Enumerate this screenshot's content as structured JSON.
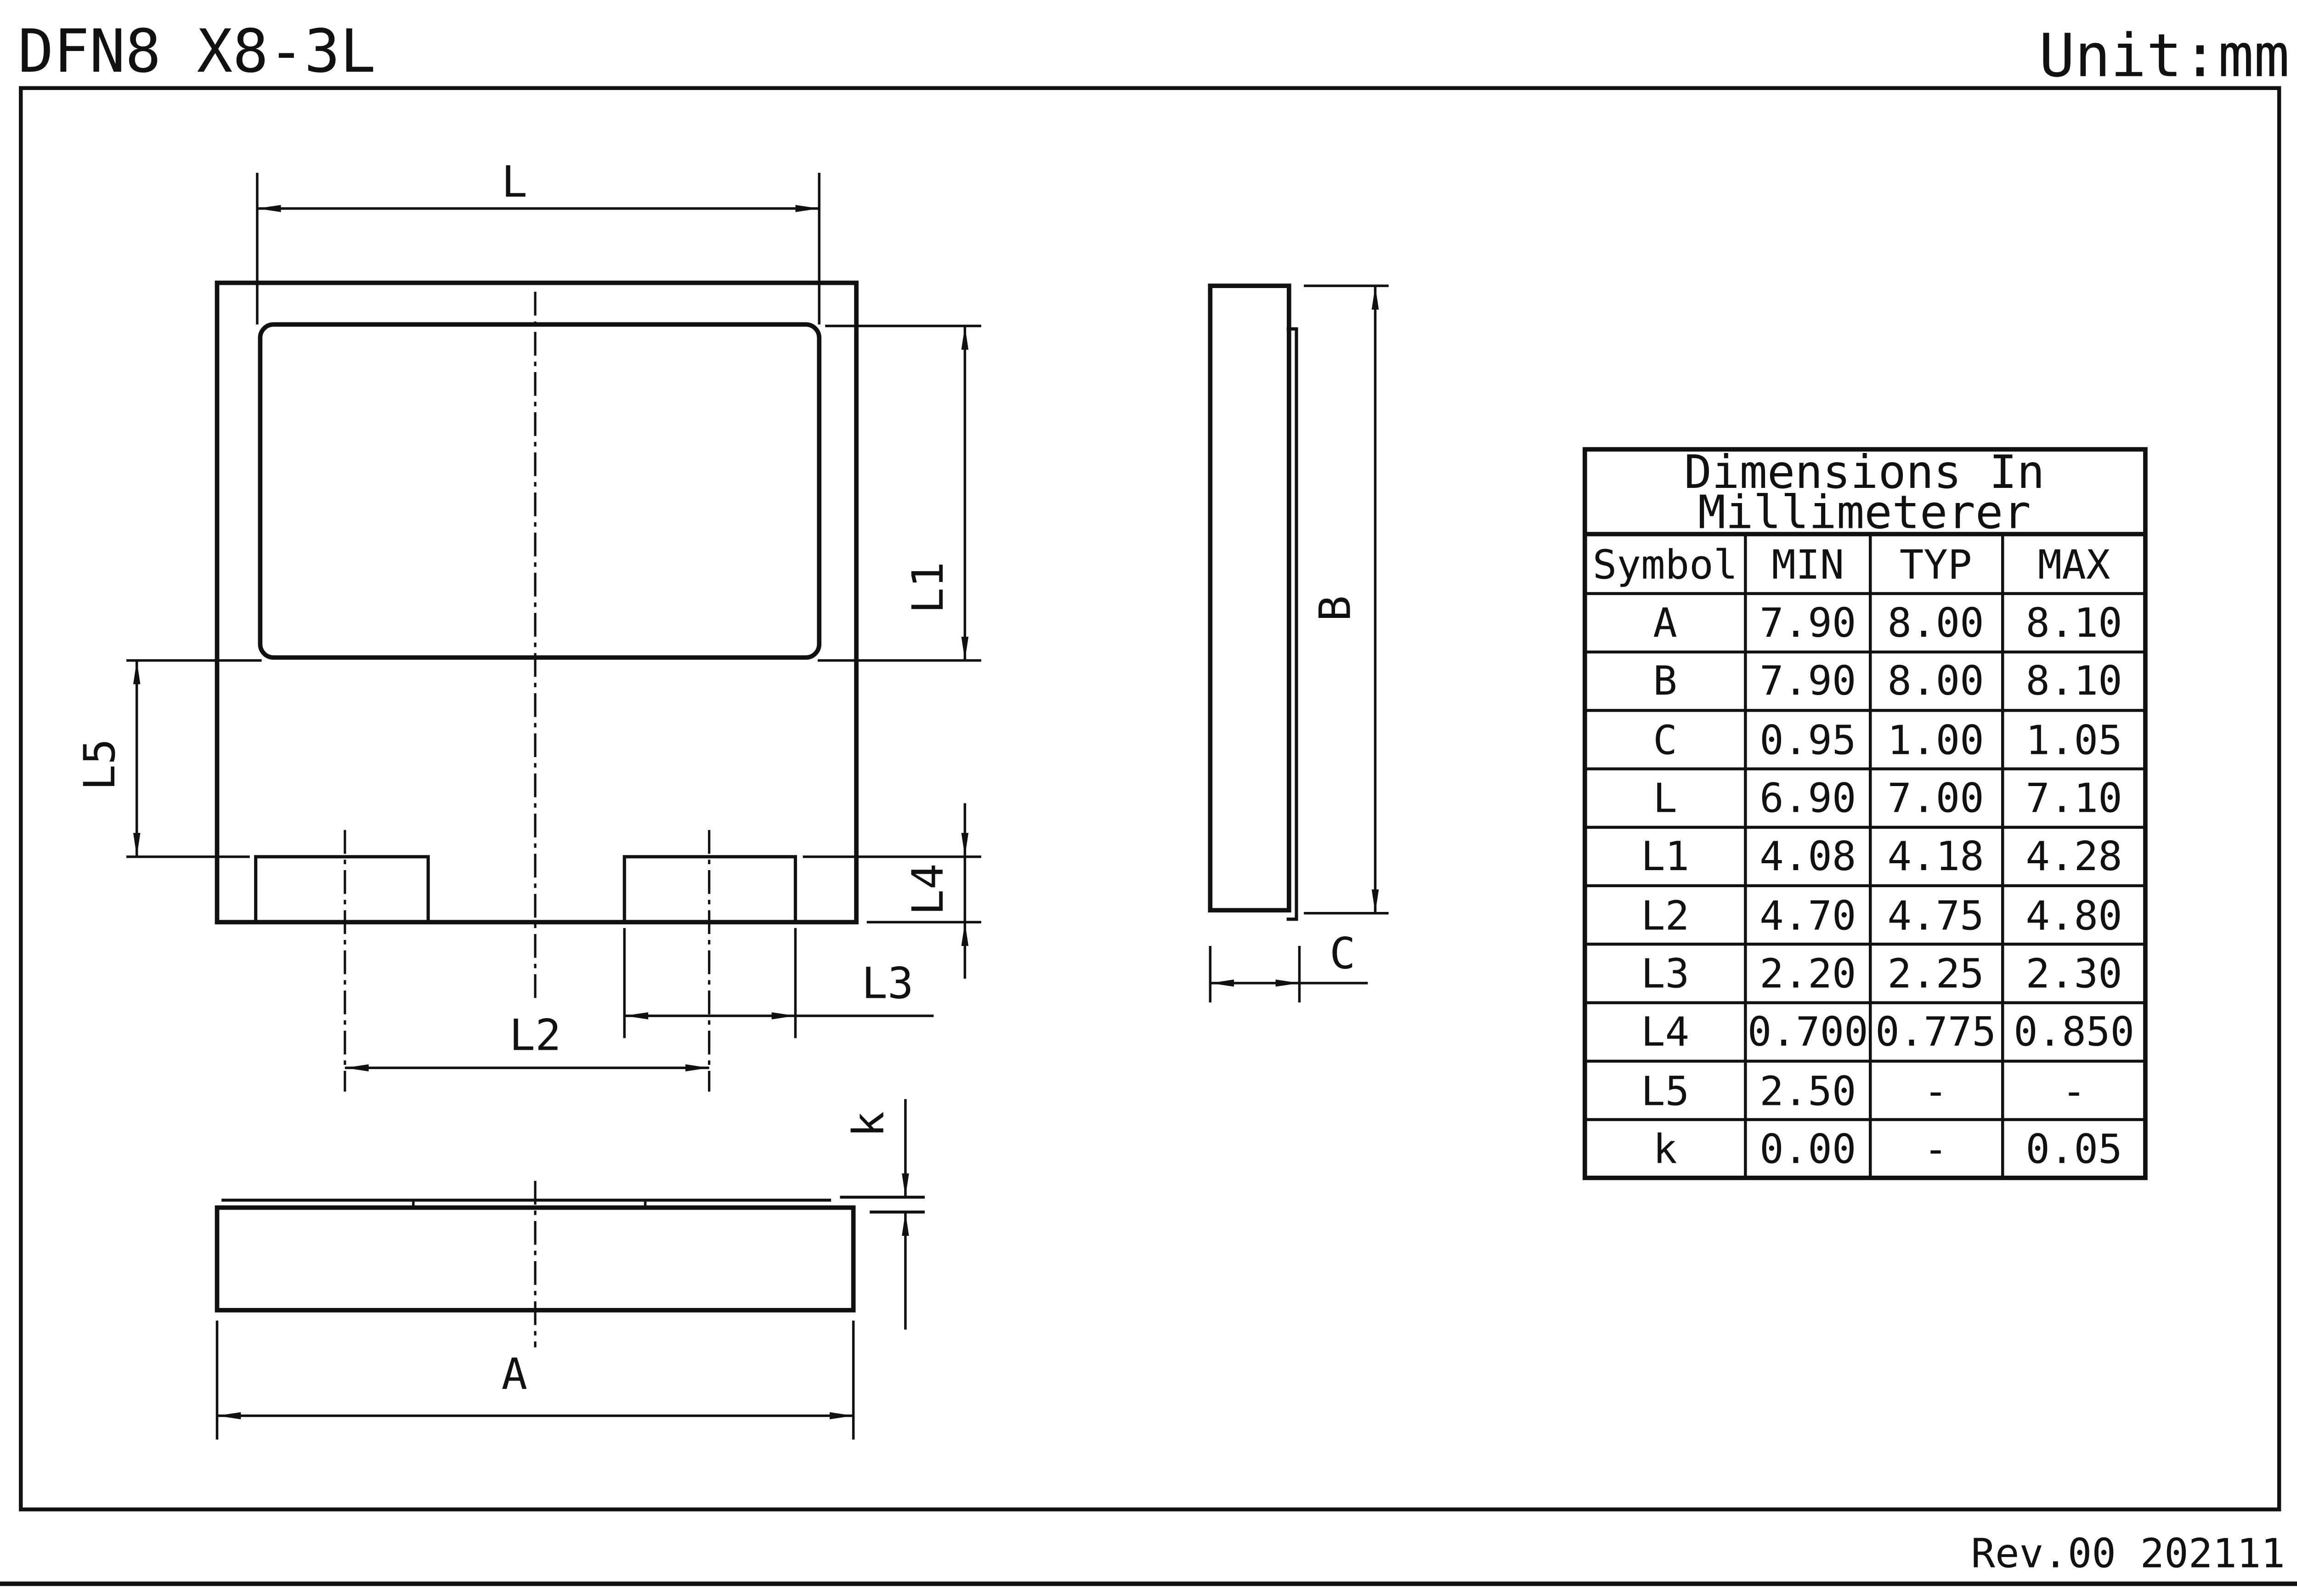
{
  "page": {
    "title": "DFN8 X8-3L",
    "unit_label": "Unit:mm",
    "revision": "Rev.00  202111"
  },
  "table": {
    "title_line1": "Dimensions  In",
    "title_line2": "Millimeterer",
    "headers": {
      "symbol": "Symbol",
      "min": "MIN",
      "typ": "TYP",
      "max": "MAX"
    },
    "rows": [
      {
        "symbol": "A",
        "min": "7.90",
        "typ": "8.00",
        "max": "8.10"
      },
      {
        "symbol": "B",
        "min": "7.90",
        "typ": "8.00",
        "max": "8.10"
      },
      {
        "symbol": "C",
        "min": "0.95",
        "typ": "1.00",
        "max": "1.05"
      },
      {
        "symbol": "L",
        "min": "6.90",
        "typ": "7.00",
        "max": "7.10"
      },
      {
        "symbol": "L1",
        "min": "4.08",
        "typ": "4.18",
        "max": "4.28"
      },
      {
        "symbol": "L2",
        "min": "4.70",
        "typ": "4.75",
        "max": "4.80"
      },
      {
        "symbol": "L3",
        "min": "2.20",
        "typ": "2.25",
        "max": "2.30"
      },
      {
        "symbol": "L4",
        "min": "0.700",
        "typ": "0.775",
        "max": "0.850"
      },
      {
        "symbol": "L5",
        "min": "2.50",
        "typ": "-",
        "max": "-"
      },
      {
        "symbol": "k",
        "min": "0.00",
        "typ": "-",
        "max": "0.05"
      }
    ]
  },
  "labels": {
    "top_view": {
      "L": "L",
      "L1": "L1",
      "L2": "L2",
      "L3": "L3",
      "L4": "L4",
      "L5": "L5"
    },
    "side_view": {
      "B": "B",
      "C": "C"
    },
    "bottom_view": {
      "A": "A",
      "k": "k"
    }
  }
}
